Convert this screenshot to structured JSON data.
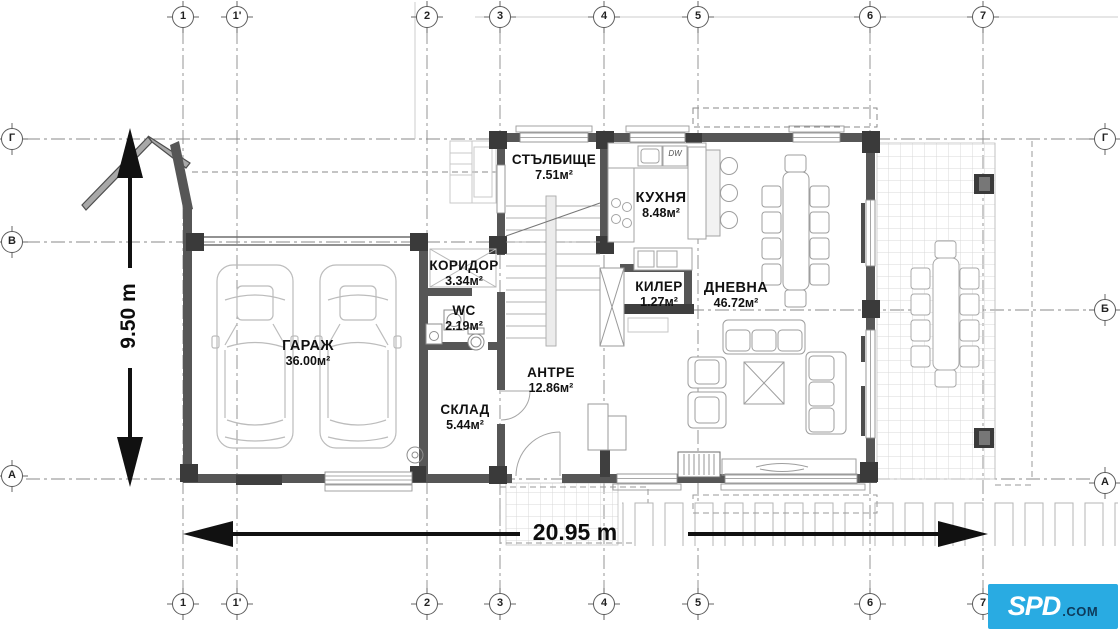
{
  "axes": {
    "top": [
      "1",
      "1'",
      "2",
      "3",
      "4",
      "5",
      "6",
      "7"
    ],
    "bottom": [
      "1",
      "1'",
      "2",
      "3",
      "4",
      "5",
      "6",
      "7"
    ],
    "left": [
      "Г",
      "В",
      "А"
    ],
    "right": [
      "Г",
      "Б",
      "А"
    ]
  },
  "rooms": [
    {
      "name": "СТЪЛБИЩЕ",
      "area": "7.51м²"
    },
    {
      "name": "КУХНЯ",
      "area": "8.48м²"
    },
    {
      "name": "КОРИДОР",
      "area": "3.34м²"
    },
    {
      "name": "WC",
      "area": "2.19м²"
    },
    {
      "name": "ГАРАЖ",
      "area": "36.00м²"
    },
    {
      "name": "СКЛАД",
      "area": "5.44м²"
    },
    {
      "name": "АНТРЕ",
      "area": "12.86м²"
    },
    {
      "name": "КИЛЕР",
      "area": "1.27м²"
    },
    {
      "name": "ДНЕВНА",
      "area": "46.72м²"
    }
  ],
  "dimensions": {
    "horizontal": "20.95 m",
    "vertical": "9.50 m"
  },
  "labels": {
    "dishwasher": "DW"
  },
  "logo": {
    "name": "SPD",
    "tld": ".COM",
    "background": "#29abe2",
    "name_color": "#ffffff",
    "tld_color": "#0e3a5a"
  },
  "colors": {
    "wall": "#565656",
    "column": "#3a3a3a",
    "furniture": "#9e9e9e",
    "axis_line": "#8a8a8a",
    "dimension": "#111111"
  }
}
